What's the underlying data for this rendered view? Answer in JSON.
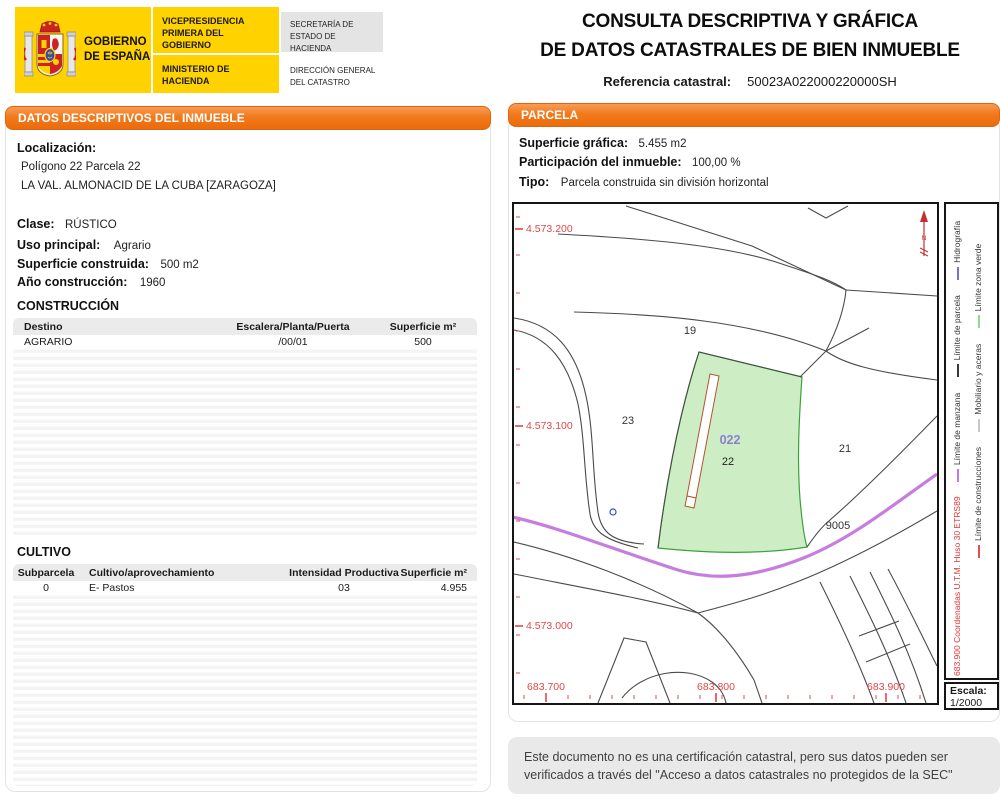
{
  "header": {
    "logo": {
      "government": "GOBIERNO DE ESPAÑA",
      "vicepresidencia": "VICEPRESIDENCIA PRIMERA DEL GOBIERNO",
      "ministerio": "MINISTERIO DE HACIENDA",
      "secretaria": "SECRETARÍA DE ESTADO DE HACIENDA",
      "direccion": "DIRECCIÓN GENERAL DEL CATASTRO"
    },
    "title_line1": "CONSULTA DESCRIPTIVA Y GRÁFICA",
    "title_line2": "DE DATOS CATASTRALES DE BIEN INMUEBLE",
    "ref_label": "Referencia catastral:",
    "ref_value": "50023A022000220000SH"
  },
  "left_panel": {
    "header": "DATOS DESCRIPTIVOS DEL INMUEBLE",
    "localizacion_label": "Localización:",
    "localizacion_line1": "Polígono 22 Parcela 22",
    "localizacion_line2": "LA VAL. ALMONACID DE LA CUBA [ZARAGOZA]",
    "fields": [
      {
        "label": "Clase:",
        "value": "RÚSTICO"
      },
      {
        "label": "Uso principal:",
        "value": "Agrario"
      },
      {
        "label": "Superficie construida:",
        "value": "500 m2"
      },
      {
        "label": "Año construcción:",
        "value": "1960"
      }
    ],
    "construccion": {
      "title": "CONSTRUCCIÓN",
      "headers": [
        "Destino",
        "Escalera/Planta/Puerta",
        "Superficie m²"
      ],
      "rows": [
        [
          "AGRARIO",
          "/00/01",
          "500"
        ]
      ]
    },
    "cultivo": {
      "title": "CULTIVO",
      "headers": [
        "Subparcela",
        "Cultivo/aprovechamiento",
        "Intensidad Productiva",
        "Superficie m²"
      ],
      "rows": [
        [
          "0",
          "E- Pastos",
          "03",
          "4.955"
        ]
      ]
    }
  },
  "right_panel": {
    "header": "PARCELA",
    "fields": [
      {
        "label": "Superficie gráfica:",
        "value": "5.455 m2"
      },
      {
        "label": "Participación del inmueble:",
        "value": "100,00 %"
      },
      {
        "label": "Tipo:",
        "value": "Parcela construida sin división horizontal"
      }
    ],
    "map": {
      "y_labels": [
        "4.573.200",
        "4.573.100",
        "4.573.000"
      ],
      "x_labels": [
        "683.700",
        "683.800",
        "683.900"
      ],
      "parcels": {
        "p19": "19",
        "p23": "23",
        "p21": "21",
        "p9005": "9005",
        "subparcel": "022",
        "parcel": "22"
      },
      "colors": {
        "parcel_fill": "#cdeec4",
        "parcel_stroke": "#3aa23a",
        "building_outline": "#b5532f",
        "road_accent": "#c77de0",
        "coordinates_text": "#e04848",
        "boundary_lines": "#4a4a4a",
        "subparcel_label": "#8a7fd6"
      }
    },
    "legend": {
      "coords_note": "683.900 Coordenadas U.T.M. Huso 30 ETRS89",
      "row1": [
        "Límite de manzana",
        "Límite de parcela",
        "Hidrografía"
      ],
      "row2": [
        "Límite de construcciones",
        "Mobiliario y aceras",
        "Límite zona verde"
      ]
    },
    "escala_label": "Escala:",
    "escala_value": "1/2000"
  },
  "footer": {
    "disclaimer": "Este documento no es una certificación catastral, pero sus datos pueden ser verificados a través del \"Acceso a datos catastrales no protegidos de la SEC\""
  },
  "theme": {
    "accent_orange": "#ee7511",
    "flag_yellow": "#ffd200",
    "header_gray": "#e4e4e4",
    "disclaimer_gray": "#e9e9e9"
  }
}
